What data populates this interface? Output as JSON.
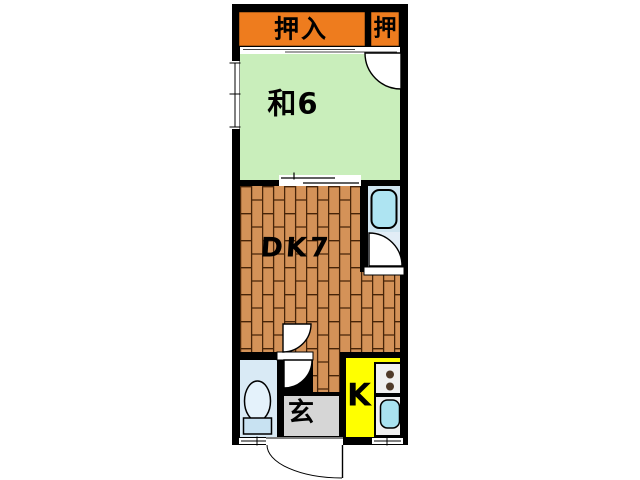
{
  "plan": {
    "type": "japanese-apartment-floorplan",
    "labels": {
      "closet_main": "押入",
      "closet_small": "押",
      "japanese_room": "和6",
      "dining_kitchen": "DK7",
      "entrance": "玄",
      "kitchen": "K"
    },
    "colors": {
      "wall": "#000000",
      "closet": "#ee7c1e",
      "tatami_room": "#c9eebb",
      "wood_floor": "#d49258",
      "wood_joint": "#472408",
      "bath_bg": "#cfe5f0",
      "bath_door_bg": "#e2edf6",
      "bathtub": "#aee4f2",
      "toilet_room": "#d9eaf5",
      "toilet_bowl": "#e4f2fb",
      "toilet_tank": "#c8e2f2",
      "entrance_floor": "#d6d6d6",
      "kitchen_floor": "#ffff00",
      "counter_panel": "#f0f0f0",
      "burner_dot": "#4f3a2a",
      "sink": "#a9e2f0",
      "door_white": "#ffffff"
    },
    "fixtures": {
      "bathtub": "bathtub",
      "toilet": "toilet",
      "stove": "two-burner-stove",
      "kitchen_sink": "sink"
    }
  }
}
